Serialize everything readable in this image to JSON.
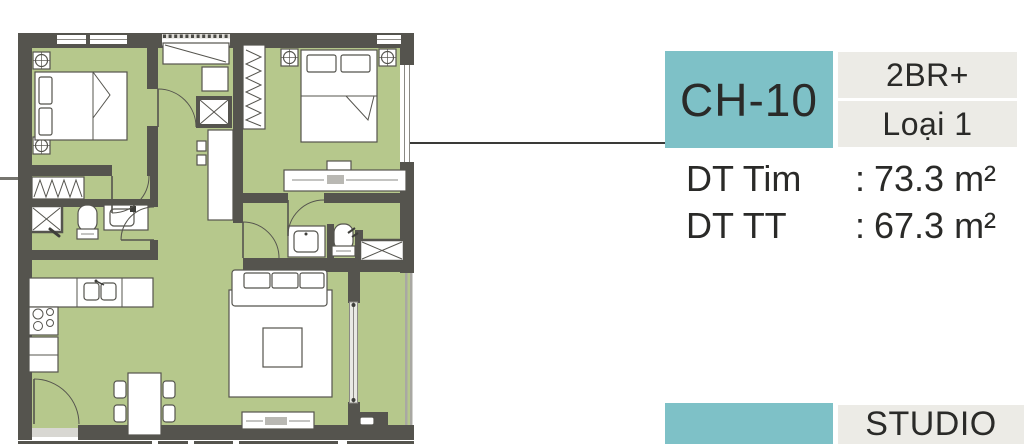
{
  "unit_card": {
    "code": "CH-10",
    "badges": [
      {
        "label": "2BR+"
      },
      {
        "label": "Loại 1"
      }
    ],
    "specs": [
      {
        "label": "DT Tim",
        "separator": ":",
        "value": "73.3 m²"
      },
      {
        "label": "DT TT",
        "separator": ":",
        "value": "67.3 m²"
      }
    ]
  },
  "next_unit_card": {
    "type_label": "STUDIO"
  },
  "colors": {
    "accent_teal": "#7ec1c7",
    "badge_gray": "#ecebe6",
    "floor_green": "#b6c88c",
    "wall_gray": "#55544e",
    "callout_line": "#3a3a38",
    "text": "#2a2a28"
  },
  "floor_plan": {
    "elements": [
      "bedroom-1-bed",
      "bedroom-2-bed",
      "nightstand-lamp",
      "study-desk",
      "shaft-x-box",
      "hall-wardrobe",
      "closet-hangers",
      "bathroom-1",
      "bathroom-2",
      "kitchen-counter",
      "stove-burners",
      "dining-table",
      "sofa",
      "living-rug",
      "tv-console",
      "balcony-sliding-door",
      "entry-door",
      "balcony-railing"
    ]
  }
}
